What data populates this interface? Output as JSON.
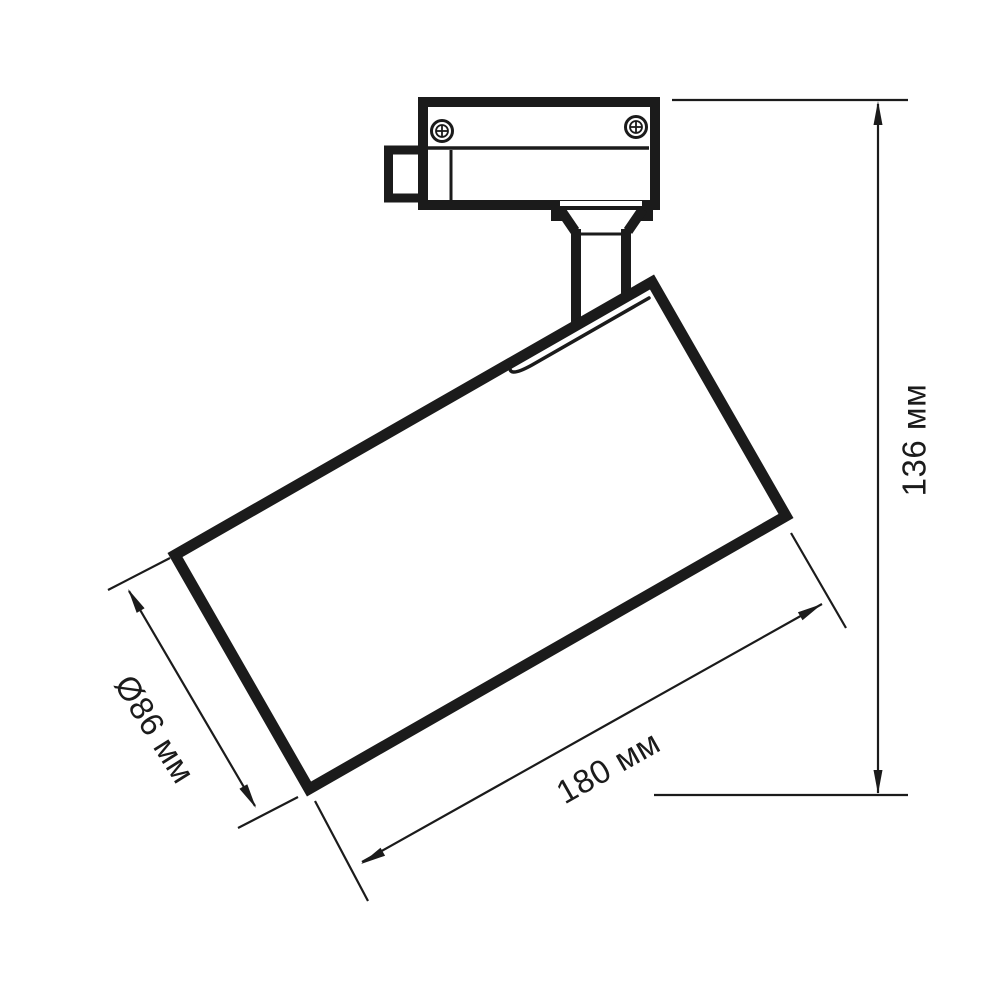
{
  "diagram": {
    "type": "technical-dimension-drawing",
    "subject": "LED track light fixture (side view)",
    "background_color": "#ffffff",
    "line_color": "#1b1b1b",
    "dimensions": {
      "height": {
        "label": "136 мм",
        "value": 136,
        "unit": "мм",
        "orientation": "vertical-right"
      },
      "length": {
        "label": "180 мм",
        "value": 180,
        "unit": "мм",
        "orientation": "diagonal-bottom"
      },
      "diameter": {
        "label": "Ø86 мм",
        "value": 86,
        "unit": "мм",
        "orientation": "diagonal-left"
      }
    }
  }
}
